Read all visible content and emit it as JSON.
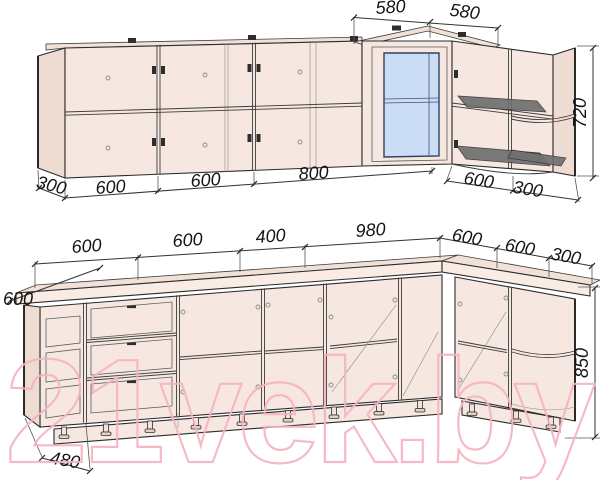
{
  "watermark": {
    "text": "21vek.by",
    "color": "#f6b3c0"
  },
  "drawing": {
    "type": "kitchen corner cabinet set dimension drawing",
    "upper": {
      "top_widths": [
        "580",
        "580"
      ],
      "height": "720",
      "bottom_left_widths": [
        "300",
        "600",
        "600",
        "800"
      ],
      "bottom_right_widths": [
        "600",
        "300"
      ]
    },
    "base": {
      "top_widths": [
        "600",
        "600",
        "400",
        "980",
        "600",
        "600",
        "300"
      ],
      "depth_left": "600",
      "height": "850",
      "plinth_depth": "480"
    },
    "colors": {
      "cabinet_fill": "#f6e8e0",
      "cabinet_side_fill": "#eedbd1",
      "glass_fill": "#cbdcf6",
      "line": "#2b2b2b",
      "dish_rack_fill": "#707070"
    }
  }
}
